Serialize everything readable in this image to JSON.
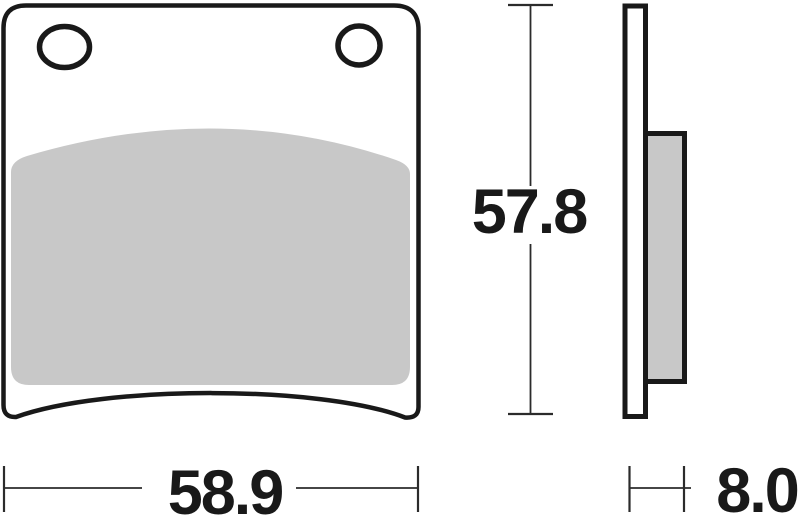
{
  "dimensions": {
    "height": "57.8",
    "width": "58.9",
    "thickness": "8.0"
  },
  "colors": {
    "line": "#191919",
    "friction": "#c8c8c8",
    "dim": "#2b2b2b",
    "text": "#191919",
    "background": "#ffffff"
  }
}
